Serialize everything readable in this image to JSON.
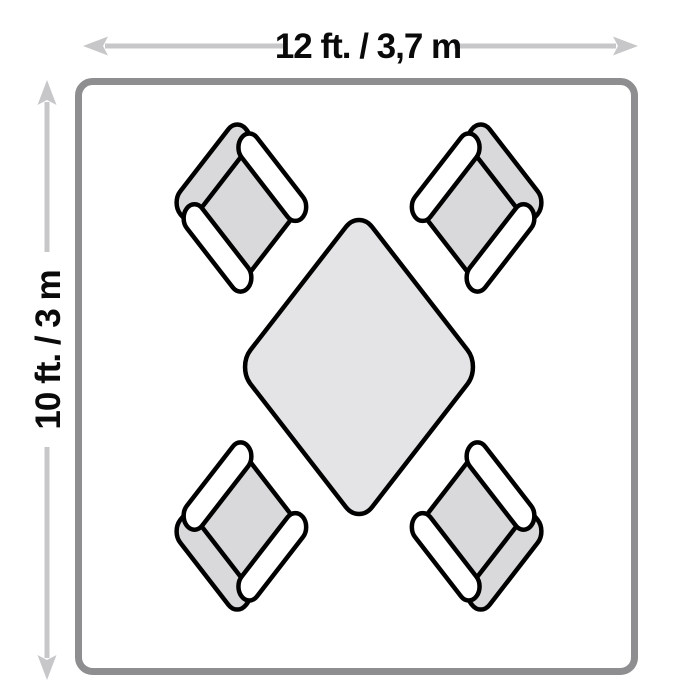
{
  "page": {
    "type": "room-layout-floor-plan",
    "background": "#ffffff"
  },
  "dimensions": {
    "width": {
      "label": "12 ft. / 3,7 m",
      "feet": 12,
      "meters_text": "3,7"
    },
    "height": {
      "label": "10 ft. / 3 m",
      "feet": 10,
      "meters_text": "3"
    }
  },
  "room": {
    "shape": "rounded-rectangle",
    "border_color": "#8e8e90"
  },
  "arrows": {
    "style": "double-headed",
    "color": "#c7c7c9"
  },
  "furniture": {
    "table": {
      "name": "square-dining-table",
      "rotation_deg": 45,
      "fill": "#e4e4e6",
      "outline": "#000000"
    },
    "chairs": [
      {
        "name": "chair-top-left",
        "facing": "table-center"
      },
      {
        "name": "chair-top-right",
        "facing": "table-center"
      },
      {
        "name": "chair-bottom-left",
        "facing": "table-center"
      },
      {
        "name": "chair-bottom-right",
        "facing": "table-center"
      }
    ],
    "chair_fill": "#d9d9db",
    "armrest_fill": "#ffffff",
    "outline": "#000000"
  }
}
